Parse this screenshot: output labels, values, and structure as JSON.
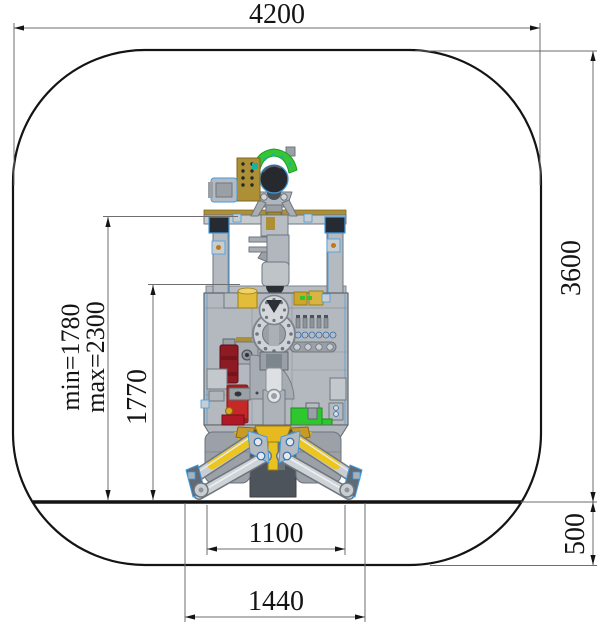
{
  "drawing": {
    "title": "tunnel-cross-section-with-drilling-robot",
    "dimensions": {
      "tunnel_width": "4200",
      "tunnel_height_above_ground": "3600",
      "invert_depth": "500",
      "track_gauge": "1100",
      "outrigger_span": "1440",
      "mast_pivot_height": "1770",
      "frame_height_min": "min=1780",
      "frame_height_max": "max=2300"
    },
    "colors": {
      "outline": "#141414",
      "dimension_line": "#6e6e6e",
      "text": "#141414",
      "machine_gray": "#b4b9bf",
      "edge_highlight_blue": "#3f9be0",
      "accent_yellow": "#e8c21f",
      "accent_red": "#c62828",
      "accent_dark_red": "#8e1a24",
      "accent_green": "#2ec82e",
      "accent_tan": "#ad8f35",
      "head_green": "#35c535"
    }
  }
}
